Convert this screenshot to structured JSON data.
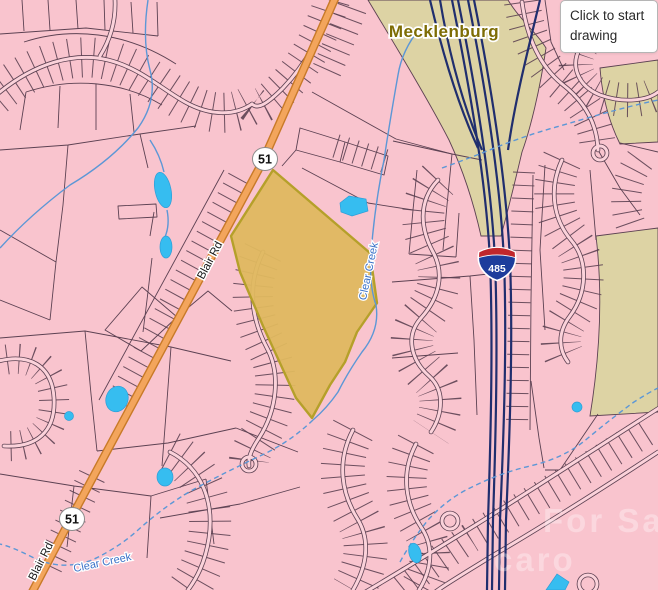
{
  "window": {
    "width": 658,
    "height": 590
  },
  "map": {
    "county_label": "Mecklenburg",
    "labels": {
      "blair_rd": "Blair Rd",
      "clear_creek": "Clear Creek"
    },
    "shields": {
      "nc_route": "51",
      "interstate": "485"
    },
    "tooltip": {
      "text": "Click to start drawing"
    },
    "watermark": {
      "line1": "For Sa",
      "line2": "caro"
    },
    "colors": {
      "background_pink": "#f9c4ce",
      "parcel_line": "#5c4152",
      "selected_parcel_fill": "#dfb85f",
      "selected_parcel_border": "#b5a02a",
      "road_orange": "#f3a55c",
      "road_orange_casing": "#c87a28",
      "interstate_navy": "#202e6e",
      "corridor_beige": "#ddd3a4",
      "creek_blue": "#5c97d6",
      "pond_cyan": "#36bdf0",
      "county_label_color": "#7d6c04",
      "interstate_shield_red": "#c0272d",
      "interstate_shield_blue": "#1d3d9c"
    }
  }
}
